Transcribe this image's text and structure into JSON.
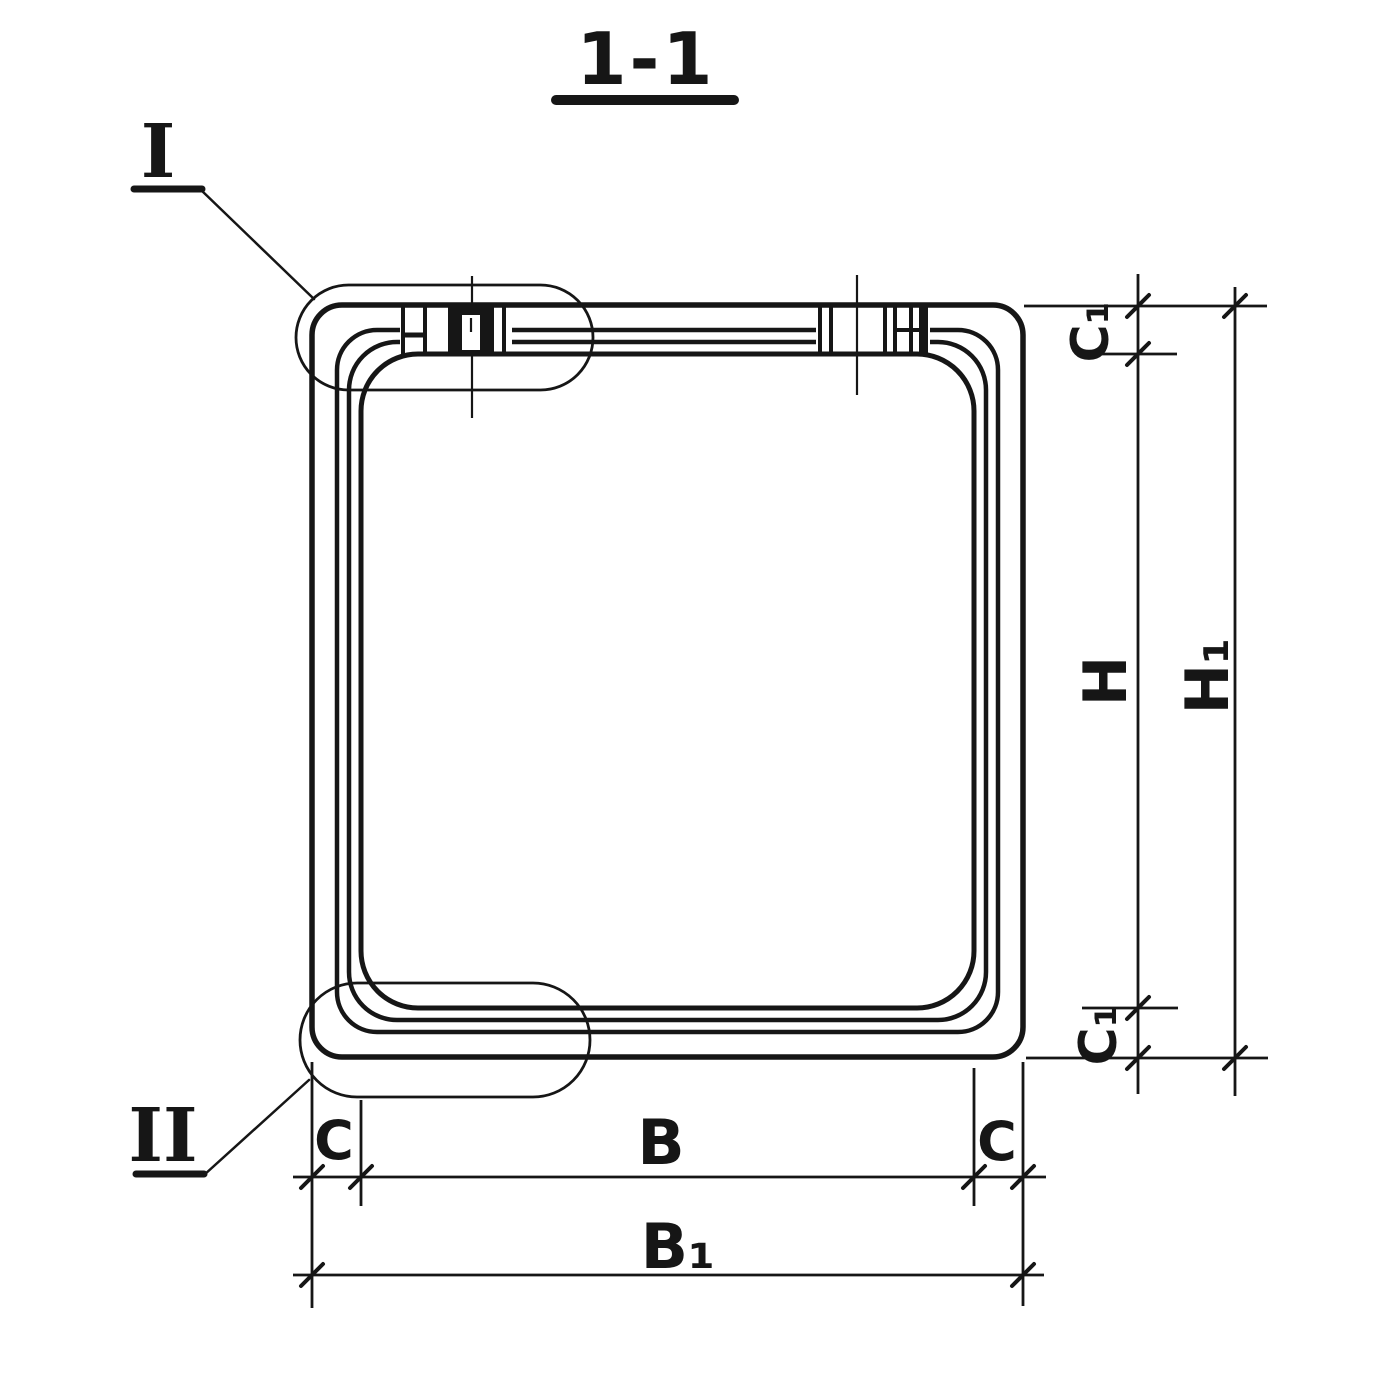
{
  "document": {
    "type": "engineering-section-drawing",
    "background_color": "#ffffff",
    "ink_color": "#161616"
  },
  "title": {
    "text": "1-1"
  },
  "details": [
    {
      "label": "I"
    },
    {
      "label": "II"
    }
  ],
  "dimensions": {
    "c1_top": "C₁",
    "h": "H",
    "h1": "H₁",
    "c1_bottom": "C₁",
    "c_left": "C",
    "b": "B",
    "c_right": "C",
    "b1": "B₁"
  }
}
